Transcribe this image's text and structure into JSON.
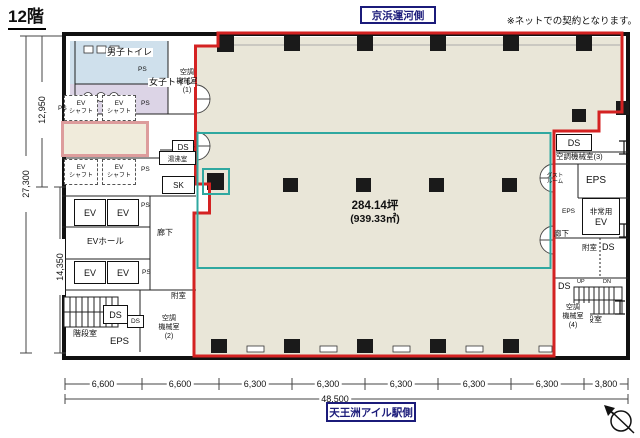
{
  "title": "12階",
  "top_label": "京浜運河側",
  "note": "※ネットでの契約となります。",
  "bottom_label": "天王洲アイル駅側",
  "area": {
    "tsubo": "284.14坪",
    "sqm": "(939.33㎡)"
  },
  "labels": {
    "mens_toilet": "男子トイレ",
    "womens_toilet": "女子トイレ",
    "ev_shaft_l1": "EV",
    "ev_shaft_l2": "シャフト",
    "ev": "EV",
    "ev_hall": "EVホール",
    "corridor": "廊下",
    "sk": "SK",
    "yuwakashi": "湯沸室",
    "ds": "DS",
    "ps": "PS",
    "eps": "EPS",
    "fushitsu": "附室",
    "kaidan": "階段室",
    "dust_l1": "ダスト",
    "dust_l2": "ルーム",
    "hijo_l1": "非常用",
    "hijo_l2": "EV",
    "up": "UP",
    "dn": "DN",
    "ac_l1": "空調",
    "ac_l2": "機械室",
    "ac1_n": "(1)",
    "ac2_n": "(2)",
    "ac3": "空調機械室(3)",
    "ac4_n": "(4)"
  },
  "dims": {
    "left": [
      "12,950",
      "27,300",
      "14,350"
    ],
    "bottom": [
      "6,600",
      "6,600",
      "6,300",
      "6,300",
      "6,300",
      "6,300",
      "6,300",
      "3,800"
    ],
    "total": "48,500"
  },
  "colors": {
    "boundary_red": "#d42222",
    "lease_teal": "#2fa8a0",
    "office_fill": "#e9e6d8",
    "mens_fill": "#cfe0ec",
    "womens_fill": "#dcd4e6",
    "pink_border": "#dd9c9c",
    "navy": "#1b1b7a"
  }
}
